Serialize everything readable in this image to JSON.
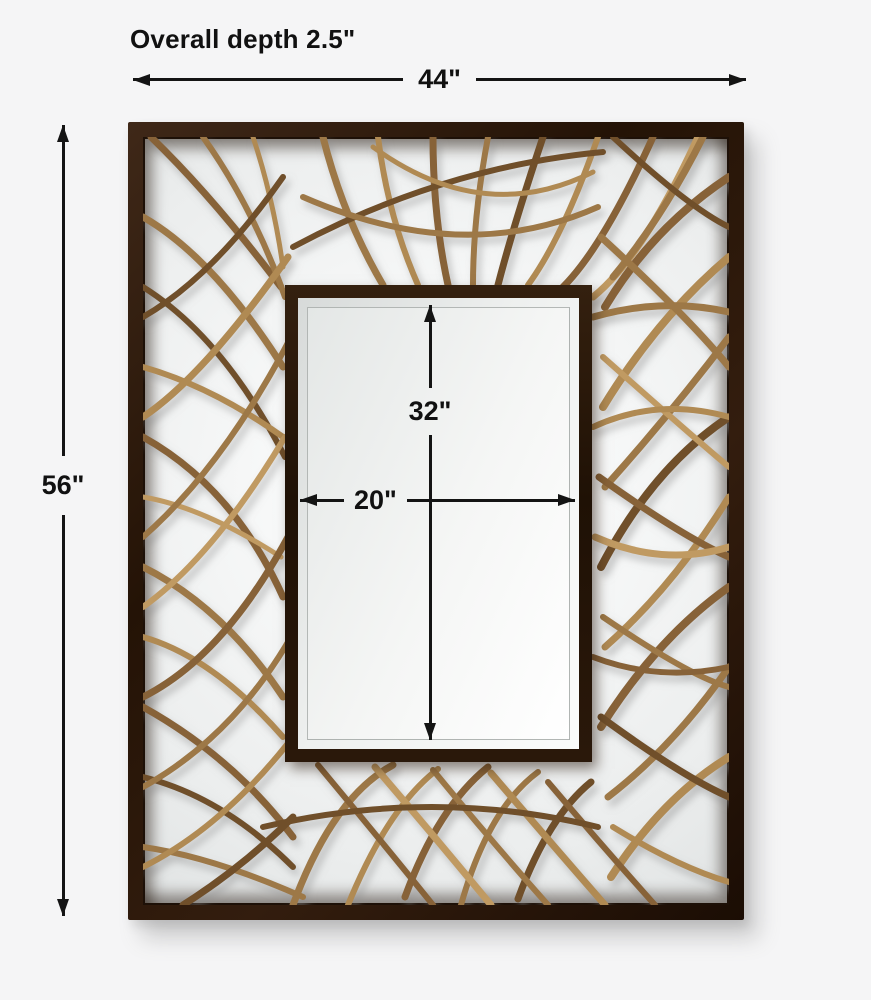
{
  "annotations": {
    "overall_depth": "Overall depth 2.5\"",
    "overall_width": "44\"",
    "overall_height": "56\"",
    "mirror_height": "32\"",
    "mirror_width": "20\""
  },
  "colors": {
    "background": "#f5f5f6",
    "frame_wood": "#2b1a0e",
    "branch_wood": "#9d7846",
    "mirror_glass": "#edefee",
    "dimension_lines": "#141414"
  }
}
